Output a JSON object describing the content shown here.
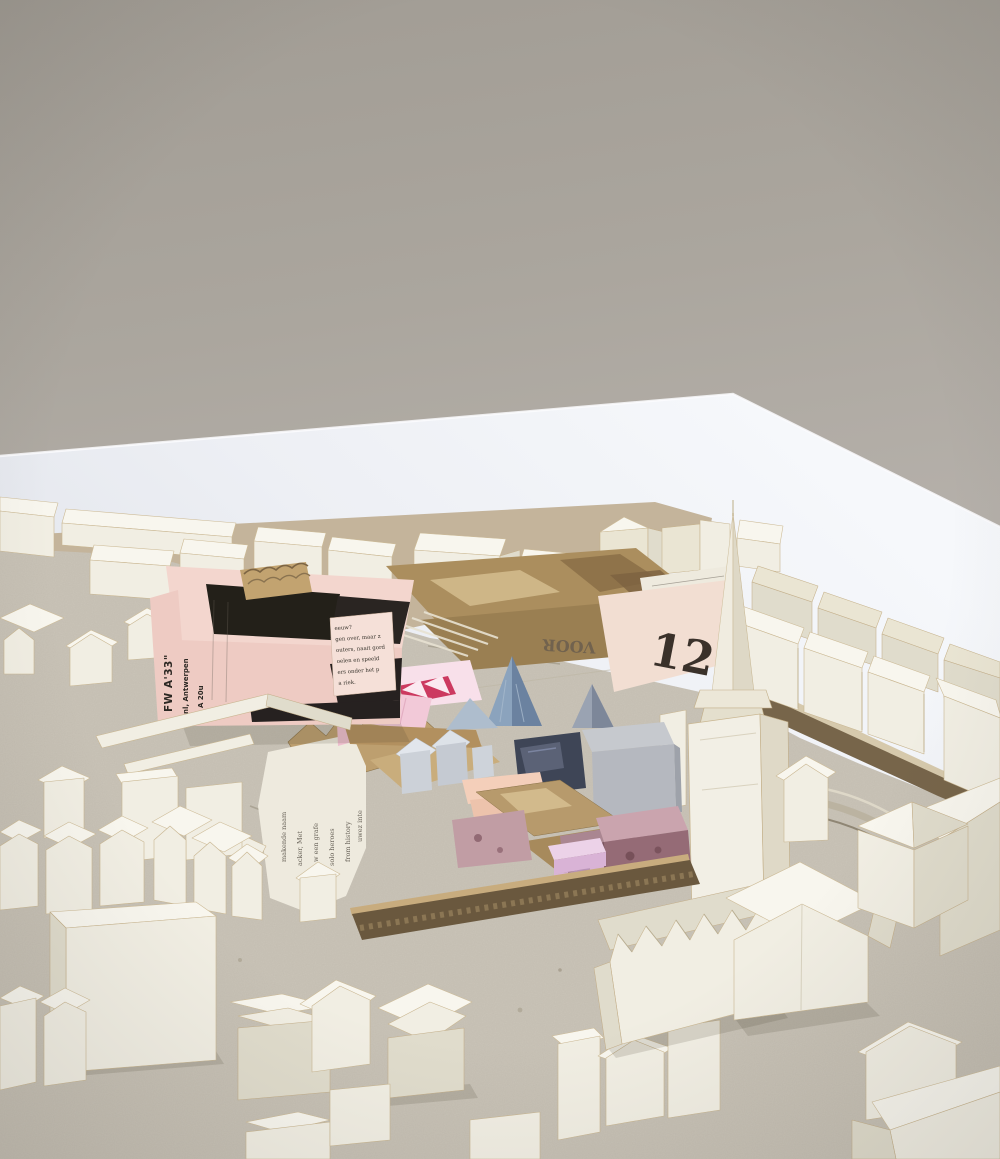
{
  "palette": {
    "wall": "#a9a49c",
    "table": "#eef0f5",
    "board_tan": "#c4b49b",
    "base": "#cac4b8",
    "cardboard": "#ab8e5e",
    "cardboard_light": "#d2ba8c",
    "cardboard_dark": "#7c6240",
    "corrugation": "#6a583e",
    "pink_poster": "#eecbc3",
    "pink_poster_top": "#f3d6ce",
    "roof_black": "#232019",
    "newsprint": "#eeeade",
    "pink_sheet": "#f2ded2",
    "origami_pink": "#f2c9d8",
    "origami_pale": "#f8e0ea",
    "crimson": "#cc3a60",
    "blue_spire": "#8ba3bd",
    "blue_spire_shade": "#6b82a0",
    "navy": "#3e4556",
    "gray_block": "#c6c9ce",
    "steel": "#b5b8bf",
    "peach": "#f4cfba",
    "lilac": "#d9b3d6",
    "floral": "#956b76",
    "plinth": "#77654a",
    "white_paper": "#f1eee3"
  },
  "texts": {
    "big_number": "12.",
    "inverted_word": "VOOR",
    "poster": {
      "title": "FW A'33\"",
      "line2": "nl, Antwerpen",
      "line3": "A  20u"
    },
    "tab_lines": [
      "eeuw?",
      "gen over, maar z",
      "outers, naait gord",
      "oelen en speeld",
      "ers onder het p",
      "a riek."
    ],
    "news_columns": [
      "makende naam",
      "acker, Met",
      "w een grafe",
      "solo heroes",
      "from history",
      "uwez inte"
    ]
  }
}
